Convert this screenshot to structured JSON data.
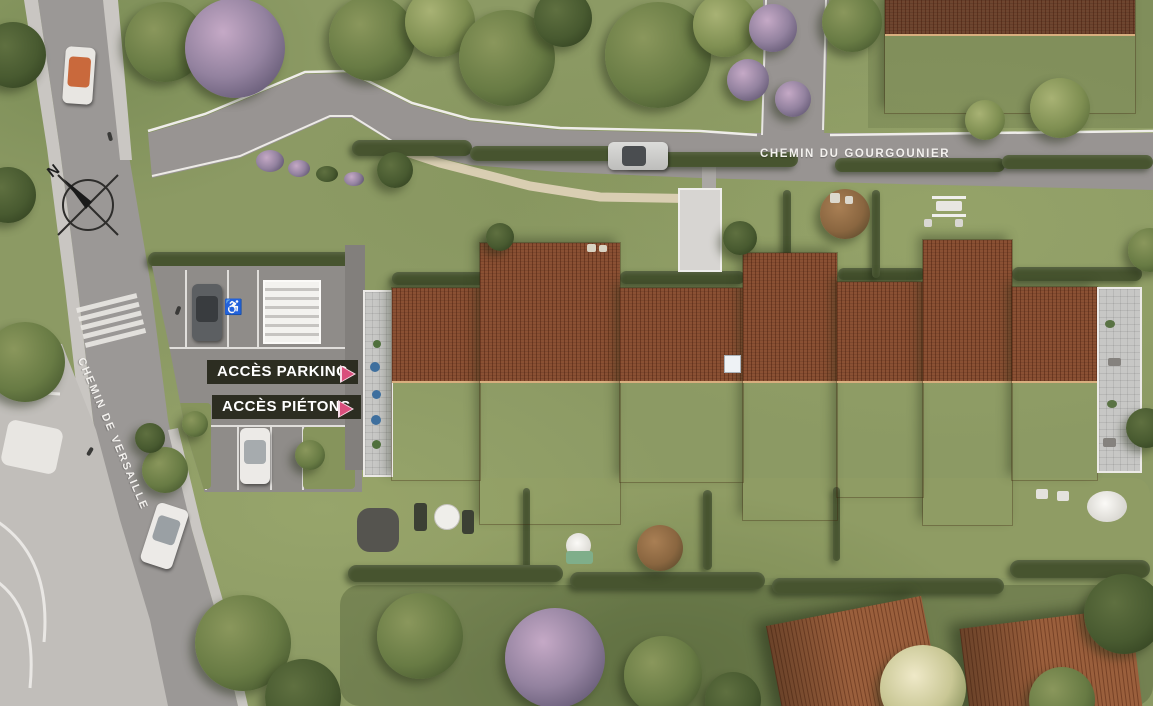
{
  "scene": {
    "type": "residential site plan (aerial render)"
  },
  "streets": {
    "top": "CHEMIN DU GOURGOUNIER",
    "left": "CHEMIN DE VERSAILLE"
  },
  "annotations": {
    "parking": "ACCÈS PARKING",
    "pedestrian": "ACCÈS PIÉTONS"
  },
  "compass": {
    "label": "N"
  },
  "symbols": {
    "handicap": "♿"
  },
  "colors": {
    "accent_pink": "#d94f7c",
    "label_bg": "#2c2d21",
    "road": "#9b9896",
    "grass": "#8c9a64",
    "roof_dark": "#8a5033",
    "roof_light": "#b97a4a"
  }
}
